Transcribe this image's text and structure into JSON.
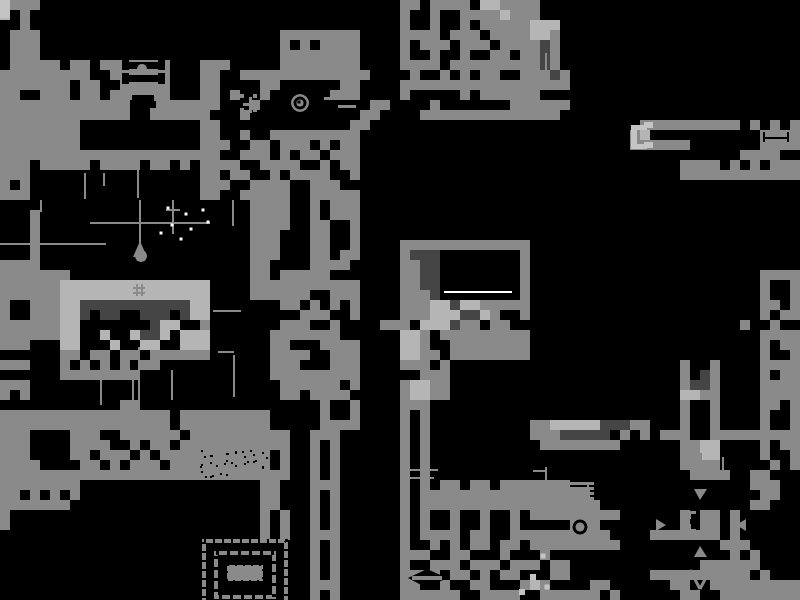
{
  "meta": {
    "label": "Monochrome pixel-art game world map",
    "background": "#000000",
    "width": 800,
    "height": 600
  },
  "palette": {
    ".": "#000000",
    "g": "#8a8a8a",
    "l": "#b5b5b5",
    "d": "#454545",
    "t": "#8a8a8a",
    "lt": "#c4c4c4",
    "wh": "#ffffff",
    "bk": "#000000"
  },
  "grid": {
    "cell": 10,
    "cols": 80,
    "rows": 60,
    "rows_data": [
      "lggg....................................gg.gggg.llgggg..........................",
      "l.g.....................................g..g..gggglggg..........................",
      "..g.....................................g..g..g.ggggglll........................",
      ".ggg........................gggggggg....gggg.ggg.ggggllg........................",
      ".ggg........................g.g.gggg....g.ggg.ggg.ggggdg........................",
      ".ggg........................gggggggg....g..g..g..gg.ggdg........................",
      ".ggggg.gg.ggggggg...ggg.....gggggggg....gggg.gggggggggdg........................",
      "ggggggggg..gggggg...gg..ggggggggggggg....g..g.g.gg..gggdg........................",
      "ggggggg.gg..ggggg...gg....gg......gg....ggggggggggggggggg........................",
      "gg..ggg.gg.gggggg...gg.g..g......ggg....g.....g.gggggg..........................",
      "ggggggggggggg..ggggggg...g...........gg....g.......gggggg..........................",
      "ggggggggggggg..gggggg...g...........gg....gggggggggggggg..........................",
      "gggggggg............gg.............gg...........................gggggggggg.g.g.gg",
      "gggggggg............gg..g..ggggggggg...........................gl...........gggg",
      "gggggggg............ggg..gg.ggg.g.gg...........................gggggg.......gggg",
      "gggggggggggggggggggggg..ggg.g.gg.ggg..............................uu......gggg",
      "ggg.ggggg.gggg.gg.g.gggg..gggg..g.gg...........................-....gggg.g.g.ggg",
      "ggg.................gg.gg..g.gggg..g...........................-....gggggggggggg",
      "g.g.................ggg..gggg..ggg..........................................",
      "ggg.................gg..ggggg..ggggg............................................",
      ".........................gggg..g.ggg............................................",
      "...g.....................gggg..g.ggg............................................",
      "...g.....................gggg..gg..g............................................",
      "...g.....................ggg...gg..g............................................",
      "...g.....................ggg...gg..g....ggggggggggggg...........................",
      "...g.....................ggg...gg.gg....gddd........g...........................",
      "gggg.....................gg....gggg.....ggdd........g...........................",
      "ggggggg..................gg.ggggg.......ggdd........g.......................gggg",
      "gggggglllllllllllllll....ggggggggggg....ggdd........g.......................g..g",
      "gggggglllllllllllllll....gggggg..ggg....gggd........g.......................g..g",
      "g..ggglldddddddddddll.......gg.g.g.g....ggglldllggggg.......................gg.g",
      "g..ggglld.dd..ddd.dll.........ggg..g....ggglllddlg..g.......................g.gg",
      "ggggggllfrom...dll..g.......ggg..g....ggg.llldgg.gg.......................g..g",
      "ggggggll..l..lddl.lll......ggggggg......llg.ggggggggg.......................gggg",
      "ggg...ll...l..ll..lll......gg...gggg....llg..gggggggg.......................g.gg",
      "......gg.gg.gg.gggggg......gggg..ggg....llgg.gggggggg.......................g..g",
      "ggg...g.g.g.g.gg...........ggg...ggg....ggg.g.......................g..g....gggg",
      "......gggggggg.............ggggggggg......ggg.......................g.dg....g.gg",
      "ggg.........................gggggg.g....gllgg.......................gddg....gggg",
      "g.g.........................gg.gggg.....gllgg.......................llgg....gggg",
      "............gg..................g..g....ggg.........................g..g....gg.g",
      "ggggggggggggggggg.ggggggggg.....g..g....g.g.........................g..g....g..g",
      "ggggggggggggggggg.ggggggggg.....gggg....g.g..........ggllllldddgg...g..g....g..g",
      "ggg....ggg..gggggg.gggggggggg..ggg......g.g..........gggddddd.g.g.ggg..ggggggggg",
      "ggg....gggg..g.gg.ggggggggggg..g.g......g.g...........gggggggg......ggll....g.gg",
      "ggg....gg.ggg.g.ggggttttttt.g..g.g......g.g.........................ggll....g..g",
      "gggg....gg.g.ggg.gggttttttt.g..g.g......g.g.........................gggg.....g.g",
      "ggggggggggggggggggggtttgggggg..g.g......g.g..........................gggg..gg",
      "gggggggg..................gg...ggg......g.g.gg.gg.ggggggg..................ggg",
      "gg.g.g.g..................gg...g.g......g.ggggggggggggggggg.................gg",
      "ggggggg...................gg...g.g......g.gggggggggggggggggg...............gg",
      "g.........................g.g..g.g......g.g..g..g..g.ggggggggg......g.gg.g",
      "g.........................g.g..g.g......g.g..g..g..g.....ggg........g.gg.g",
      "..........................g.g..ggg......g.gggg.gg..gggggggggg....ggggggg.g",
      "...............................g.g......g..g.g.gg.gg.ggggggggg..........ggg",
      "...............................g.g......ggg..gg...g...g..................g.g",
      "...............................g.g......g..ggg.ggg.ggg.gg.............gggggg",
      "...............................g.g......gggg.gg.g.gg...gg........gggggggggg.g",
      "...............................ggg......gg..g..gg...glg....gg......gg..ggggggggg",
      "...............................g.g......gggggg..gggg..gggggg.g......gg..ggggggggg"
    ]
  },
  "overlays": {
    "triangles": [
      {
        "p": [
          [
            694,
            489
          ],
          [
            707,
            489
          ],
          [
            700,
            500
          ]
        ],
        "c": "g",
        "name": "map-arrow-down"
      },
      {
        "p": [
          [
            694,
            557
          ],
          [
            707,
            557
          ],
          [
            700,
            546
          ]
        ],
        "c": "g",
        "name": "map-arrow-up"
      },
      {
        "p": [
          [
            656,
            519
          ],
          [
            656,
            531
          ],
          [
            666,
            525
          ]
        ],
        "c": "g",
        "name": "map-arrow-right"
      },
      {
        "p": [
          [
            746,
            519
          ],
          [
            746,
            531
          ],
          [
            736,
            525
          ]
        ],
        "c": "g",
        "name": "map-arrow-left"
      },
      {
        "p": [
          [
            133,
            257
          ],
          [
            147,
            257
          ],
          [
            140,
            241
          ]
        ],
        "c": "g",
        "name": "droplet-top"
      },
      {
        "p": [
          [
            408,
            578
          ],
          [
            427,
            569
          ],
          [
            447,
            578
          ],
          [
            427,
            588
          ]
        ],
        "c": "bk",
        "name": "lens-cavity"
      }
    ],
    "rects": [
      [
        0,
        0,
        10,
        18,
        "lt"
      ],
      [
        40,
        200,
        2,
        12,
        "g"
      ],
      [
        139,
        200,
        2,
        52,
        "g"
      ],
      [
        166,
        209,
        14,
        2,
        "g"
      ],
      [
        172,
        200,
        2,
        34,
        "g"
      ],
      [
        232,
        200,
        2,
        26,
        "g"
      ],
      [
        90,
        222,
        120,
        2,
        "g"
      ],
      [
        0,
        243,
        106,
        2,
        "g"
      ],
      [
        213,
        310,
        28,
        2,
        "g"
      ],
      [
        218,
        351,
        16,
        2,
        "g"
      ],
      [
        100,
        370,
        2,
        35,
        "g"
      ],
      [
        132,
        370,
        2,
        33,
        "g"
      ],
      [
        171,
        370,
        2,
        30,
        "g"
      ],
      [
        138,
        347,
        2,
        53,
        "g"
      ],
      [
        233,
        355,
        2,
        42,
        "g"
      ],
      [
        84,
        173,
        2,
        26,
        "g"
      ],
      [
        103,
        173,
        2,
        13,
        "g"
      ],
      [
        137,
        152,
        2,
        46,
        "g"
      ],
      [
        545,
        53,
        2,
        32,
        "g"
      ],
      [
        408,
        469,
        30,
        2,
        "g"
      ],
      [
        408,
        477,
        26,
        2,
        "g"
      ],
      [
        545,
        467,
        2,
        52,
        "g"
      ],
      [
        533,
        470,
        12,
        2,
        "g"
      ],
      [
        700,
        453,
        2,
        22,
        "g"
      ],
      [
        722,
        457,
        2,
        20,
        "g"
      ],
      [
        558,
        482,
        36,
        3,
        "g"
      ],
      [
        558,
        487,
        36,
        3,
        "g"
      ],
      [
        558,
        492,
        36,
        3,
        "g"
      ],
      [
        558,
        497,
        36,
        3,
        "g"
      ],
      [
        563,
        482,
        2,
        18,
        "g"
      ],
      [
        587,
        482,
        2,
        18,
        "g"
      ],
      [
        631,
        125,
        6,
        24,
        "lt"
      ],
      [
        631,
        125,
        16,
        5,
        "lt"
      ],
      [
        631,
        144,
        16,
        5,
        "lt"
      ],
      [
        644,
        122,
        9,
        6,
        "lt"
      ],
      [
        644,
        142,
        9,
        6,
        "lt"
      ],
      [
        444,
        291,
        68,
        2,
        "wh"
      ],
      [
        763,
        137,
        26,
        2,
        "bk"
      ],
      [
        763,
        132,
        2,
        10,
        "bk"
      ],
      [
        787,
        132,
        2,
        10,
        "bk"
      ],
      [
        136,
        284,
        2,
        12,
        "g"
      ],
      [
        141,
        284,
        2,
        12,
        "g"
      ],
      [
        133,
        287,
        12,
        2,
        "g"
      ],
      [
        133,
        292,
        12,
        2,
        "g"
      ],
      [
        125,
        62,
        36,
        7,
        "bk"
      ],
      [
        125,
        75,
        36,
        7,
        "bk"
      ],
      [
        122,
        59,
        7,
        11,
        "bk"
      ],
      [
        158,
        59,
        7,
        11,
        "bk"
      ],
      [
        122,
        73,
        7,
        11,
        "bk"
      ],
      [
        158,
        73,
        7,
        11,
        "bk"
      ],
      [
        132,
        95,
        22,
        6,
        "bk"
      ],
      [
        138,
        101,
        18,
        7,
        "bk"
      ],
      [
        249,
        97,
        3,
        16,
        "g"
      ],
      [
        243,
        103,
        15,
        3,
        "g"
      ],
      [
        324,
        97,
        16,
        3,
        "g"
      ],
      [
        338,
        105,
        18,
        3,
        "g"
      ],
      [
        412,
        576,
        30,
        4,
        "g"
      ],
      [
        688,
        511,
        3,
        8,
        "g"
      ],
      [
        688,
        511,
        8,
        3,
        "g"
      ],
      [
        704,
        511,
        8,
        3,
        "g"
      ],
      [
        709,
        511,
        3,
        8,
        "g"
      ],
      [
        688,
        524,
        3,
        8,
        "g"
      ],
      [
        688,
        529,
        8,
        3,
        "g"
      ],
      [
        704,
        529,
        8,
        3,
        "g"
      ],
      [
        709,
        524,
        3,
        8,
        "g"
      ],
      [
        227,
        565,
        36,
        16,
        "g"
      ]
    ],
    "discs": [
      [
        300,
        103,
        9,
        "g"
      ],
      [
        141,
        256,
        6,
        "g"
      ],
      [
        142,
        69,
        5,
        "g"
      ]
    ],
    "rings": [
      [
        300,
        103,
        5,
        3,
        "bk"
      ],
      [
        580,
        527,
        6,
        3,
        "bk"
      ]
    ],
    "dots": [
      [
        168,
        208,
        3,
        "wh"
      ],
      [
        186,
        214,
        3,
        "wh"
      ],
      [
        203,
        210,
        3,
        "wh"
      ],
      [
        172,
        225,
        3,
        "wh"
      ],
      [
        191,
        229,
        3,
        "wh"
      ],
      [
        208,
        222,
        3,
        "wh"
      ],
      [
        161,
        233,
        3,
        "wh"
      ],
      [
        181,
        239,
        3,
        "wh"
      ],
      [
        533,
        577,
        6,
        "lt"
      ],
      [
        543,
        556,
        5,
        "lt"
      ],
      [
        522,
        592,
        6,
        "lt"
      ],
      [
        547,
        587,
        5,
        "lt"
      ],
      [
        242,
        96,
        4,
        "g"
      ],
      [
        255,
        96,
        4,
        "g"
      ],
      [
        242,
        110,
        4,
        "g"
      ],
      [
        255,
        110,
        4,
        "g"
      ],
      [
        299,
        102,
        3,
        "bk"
      ]
    ],
    "lines": [
      [
        690,
        570,
        700,
        589,
        3,
        "g"
      ],
      [
        710,
        570,
        700,
        589,
        3,
        "g"
      ]
    ],
    "strokes": [
      [
        204,
        541,
        82,
        68,
        4,
        "g",
        null
      ],
      [
        204,
        541,
        82,
        68,
        4,
        "bk",
        [
          2,
          7
        ]
      ],
      [
        216,
        553,
        58,
        44,
        4,
        "g",
        null
      ],
      [
        216,
        553,
        58,
        44,
        4,
        "bk",
        [
          3,
          8
        ]
      ],
      [
        227,
        565,
        36,
        16,
        2,
        "bk",
        [
          2,
          6
        ]
      ]
    ]
  }
}
